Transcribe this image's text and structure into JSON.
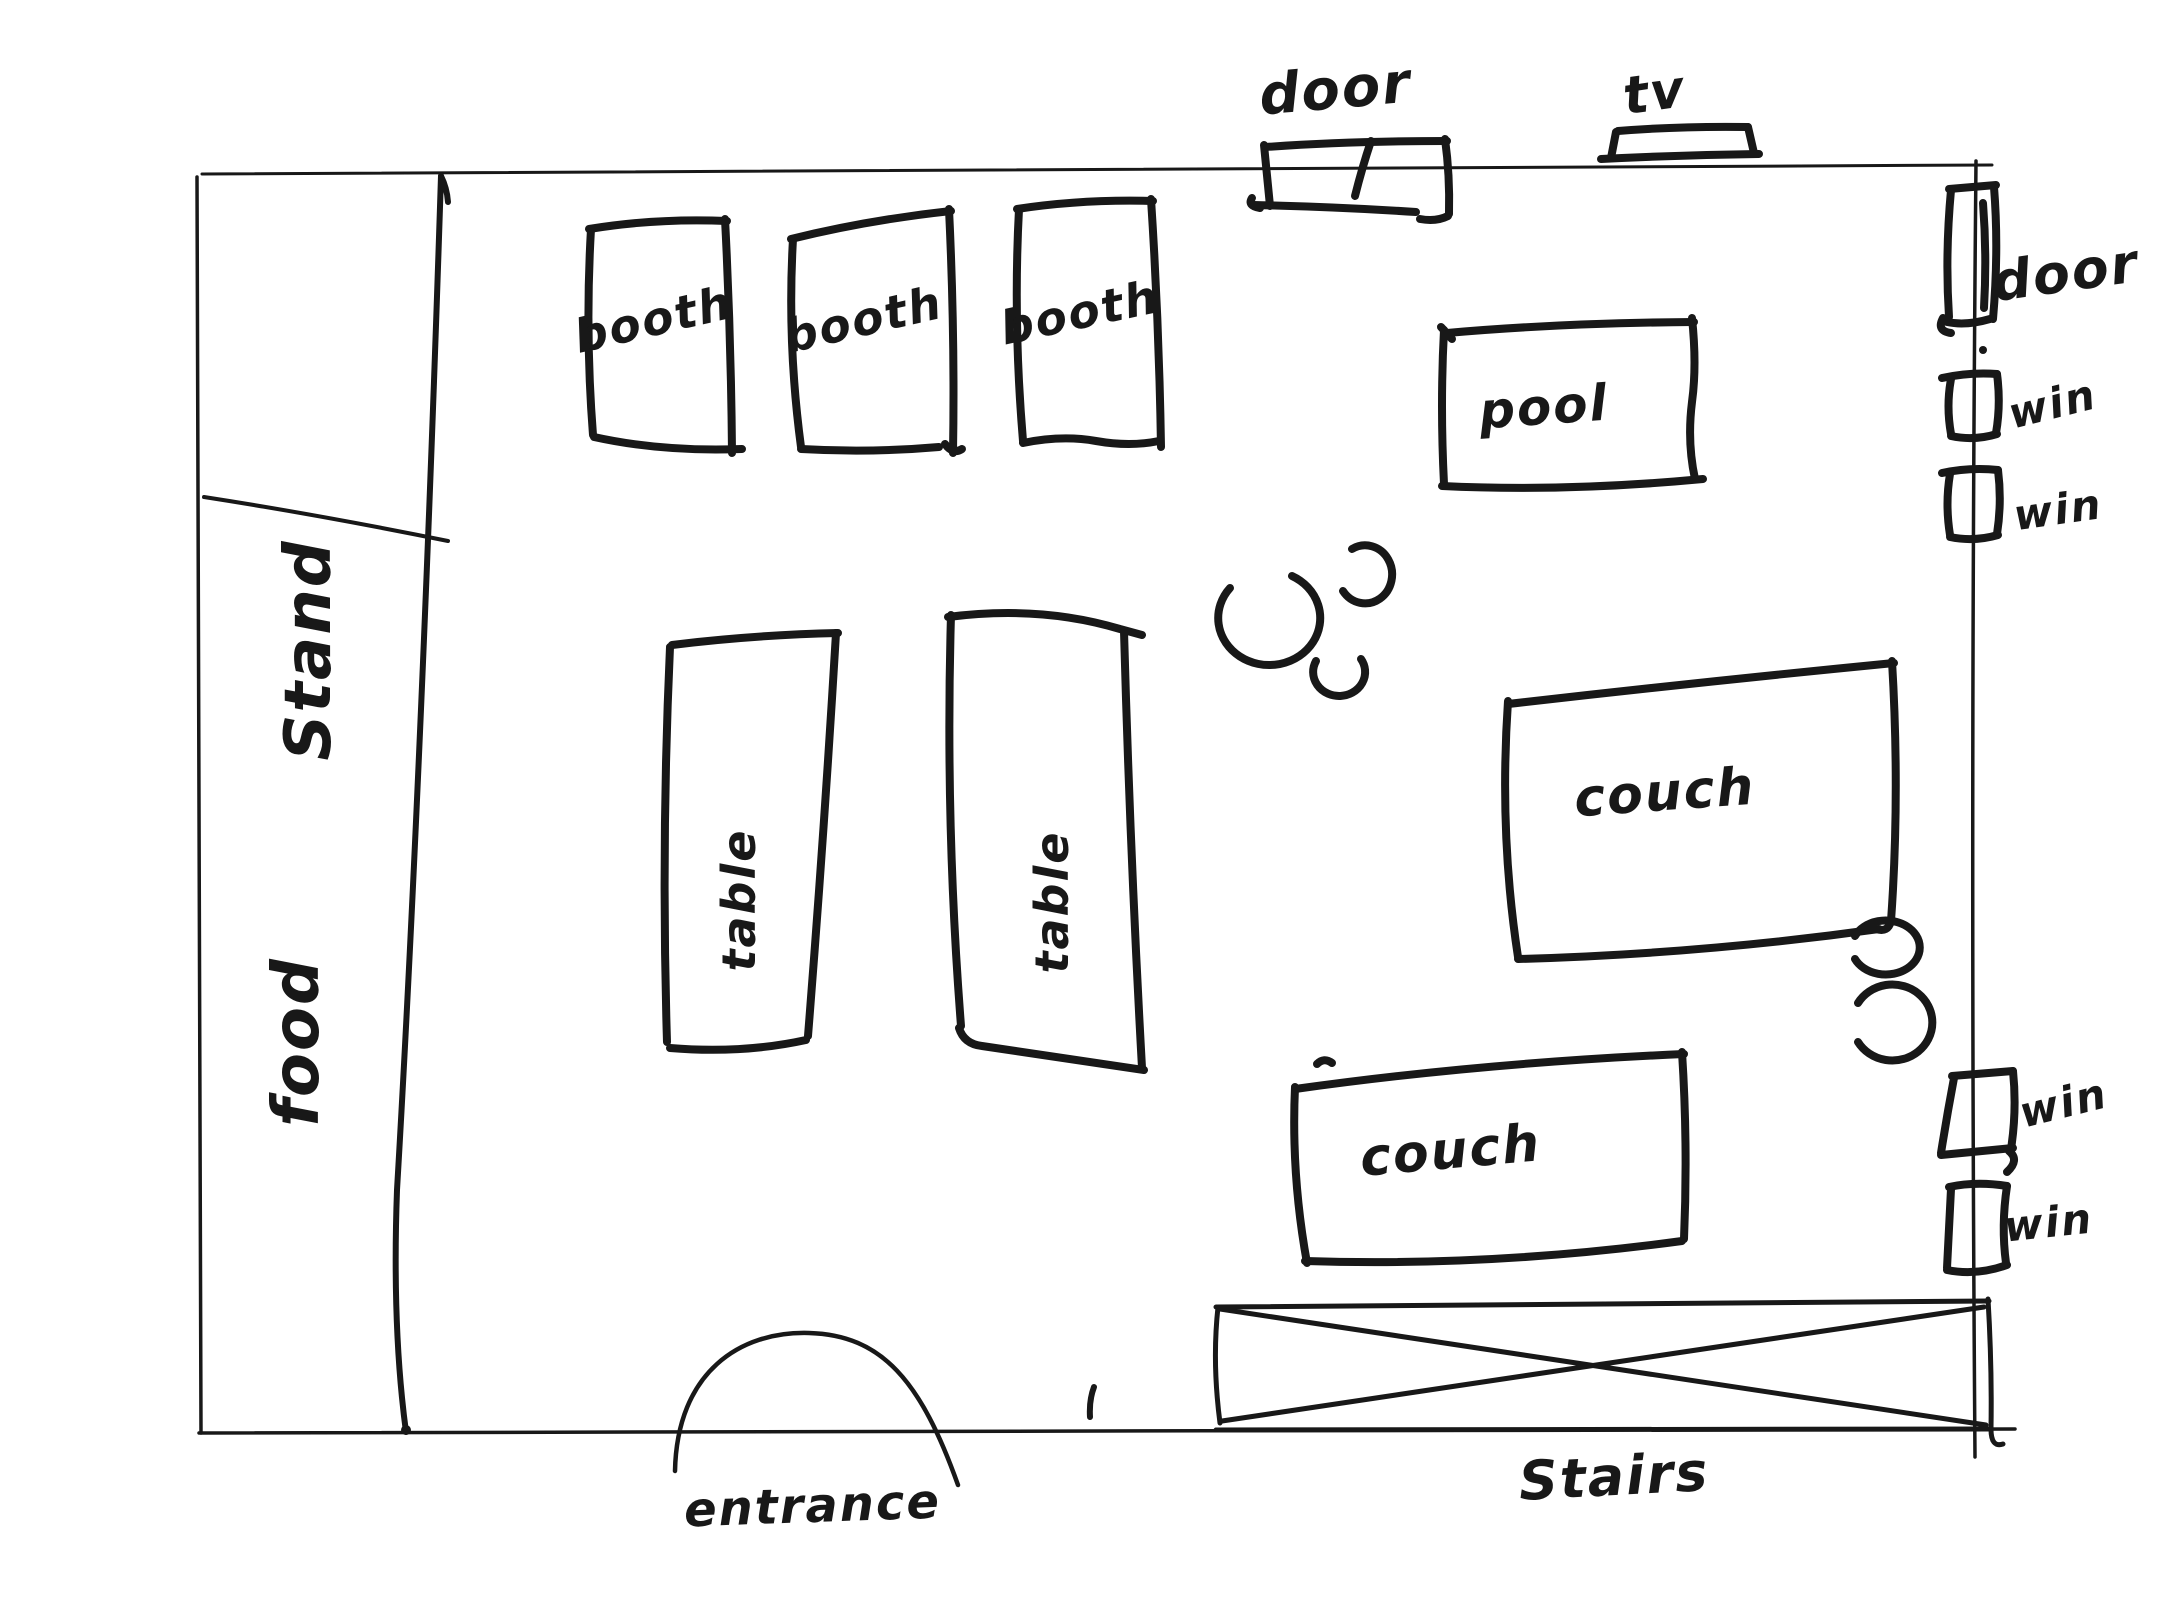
{
  "palette": {
    "ink": "#181818",
    "paper": "#ffffff"
  },
  "floorplan": {
    "areas": [
      "Stand",
      "food"
    ],
    "doors": [
      "door",
      "door"
    ],
    "windows": [
      "win",
      "win",
      "win",
      "win"
    ],
    "tv": "tv",
    "booths": [
      "booth",
      "booth",
      "booth"
    ],
    "tables": [
      "table",
      "table"
    ],
    "pool_table": "pool",
    "couches": [
      "couch",
      "couch"
    ],
    "stairs": "Stairs",
    "entrance": "entrance"
  }
}
